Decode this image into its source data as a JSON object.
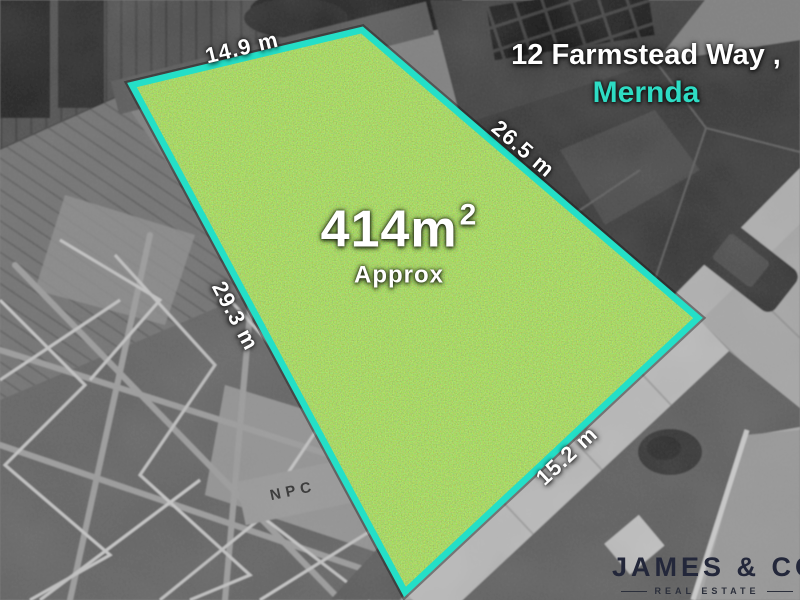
{
  "address": {
    "line1": "12 Farmstead Way ,",
    "suburb": "Mernda"
  },
  "parcel": {
    "area": "414m",
    "area_sup": "2",
    "area_note": "Approx",
    "side_top": "14.9 m",
    "side_right": "26.5 m",
    "side_left": "29.3 m",
    "side_bottom": "15.2 m",
    "outline_color": "#24dfc7",
    "grass_color": "#65ab24"
  },
  "photo": {
    "beam_stamp": "NPC"
  },
  "branding": {
    "agency": "JAMES & CO",
    "tagline": "REAL ESTATE",
    "logo_color": "#23273a"
  },
  "colors": {
    "accent_cyan": "#2edcc4",
    "label_white": "#ffffff"
  }
}
